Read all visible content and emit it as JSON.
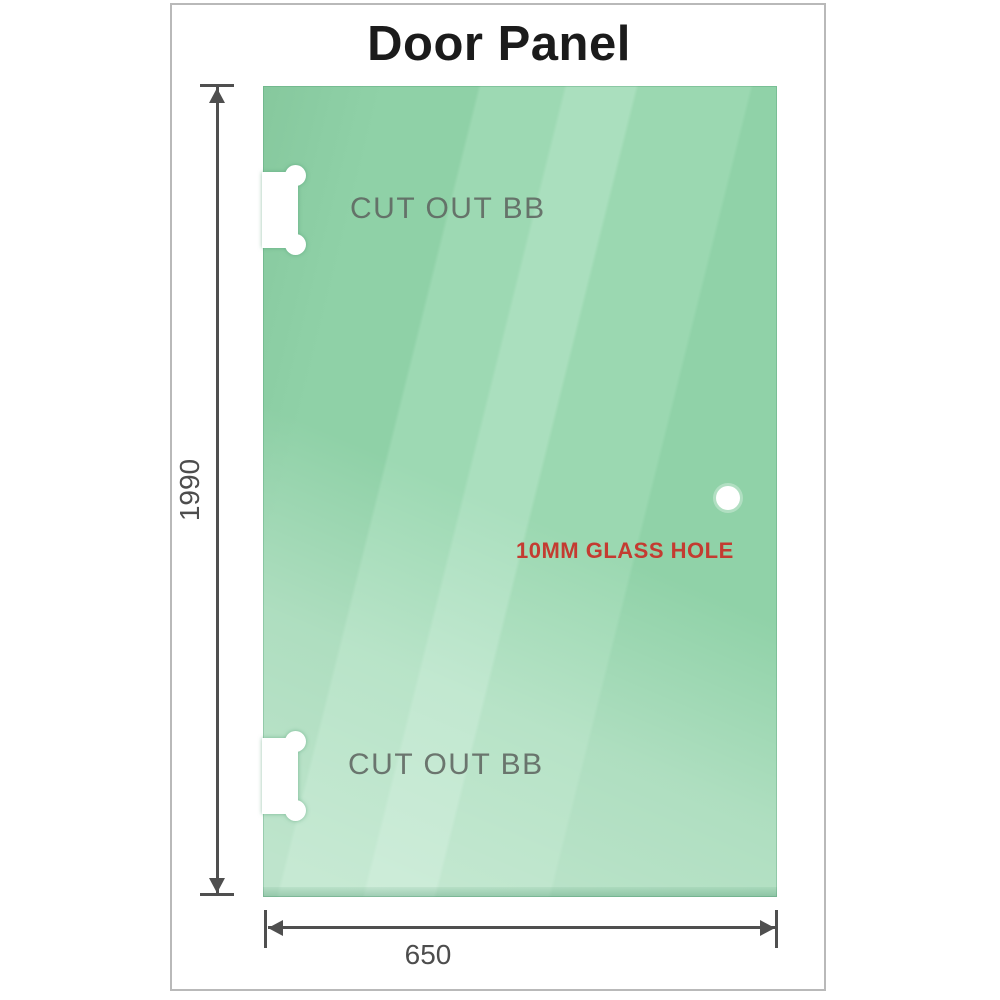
{
  "title": "Door Panel",
  "glass": {
    "cutout_top_label": "CUT OUT BB",
    "cutout_bottom_label": "CUT OUT BB",
    "hole_label": "10MM GLASS HOLE"
  },
  "dimensions": {
    "height_value": "1990",
    "width_value": "650"
  },
  "colors": {
    "glass_green_base": "#8fd1a7",
    "glass_green_light": "#aadfbe",
    "glass_green_dark_edge": "#7bc093",
    "dimension_gray": "#4f4f4f",
    "cutout_label_gray": "#5f6661",
    "hole_label_red": "#c43b31",
    "title_color": "#1b1b1b",
    "frame_border": "#b9b9b9",
    "background": "#ffffff"
  }
}
